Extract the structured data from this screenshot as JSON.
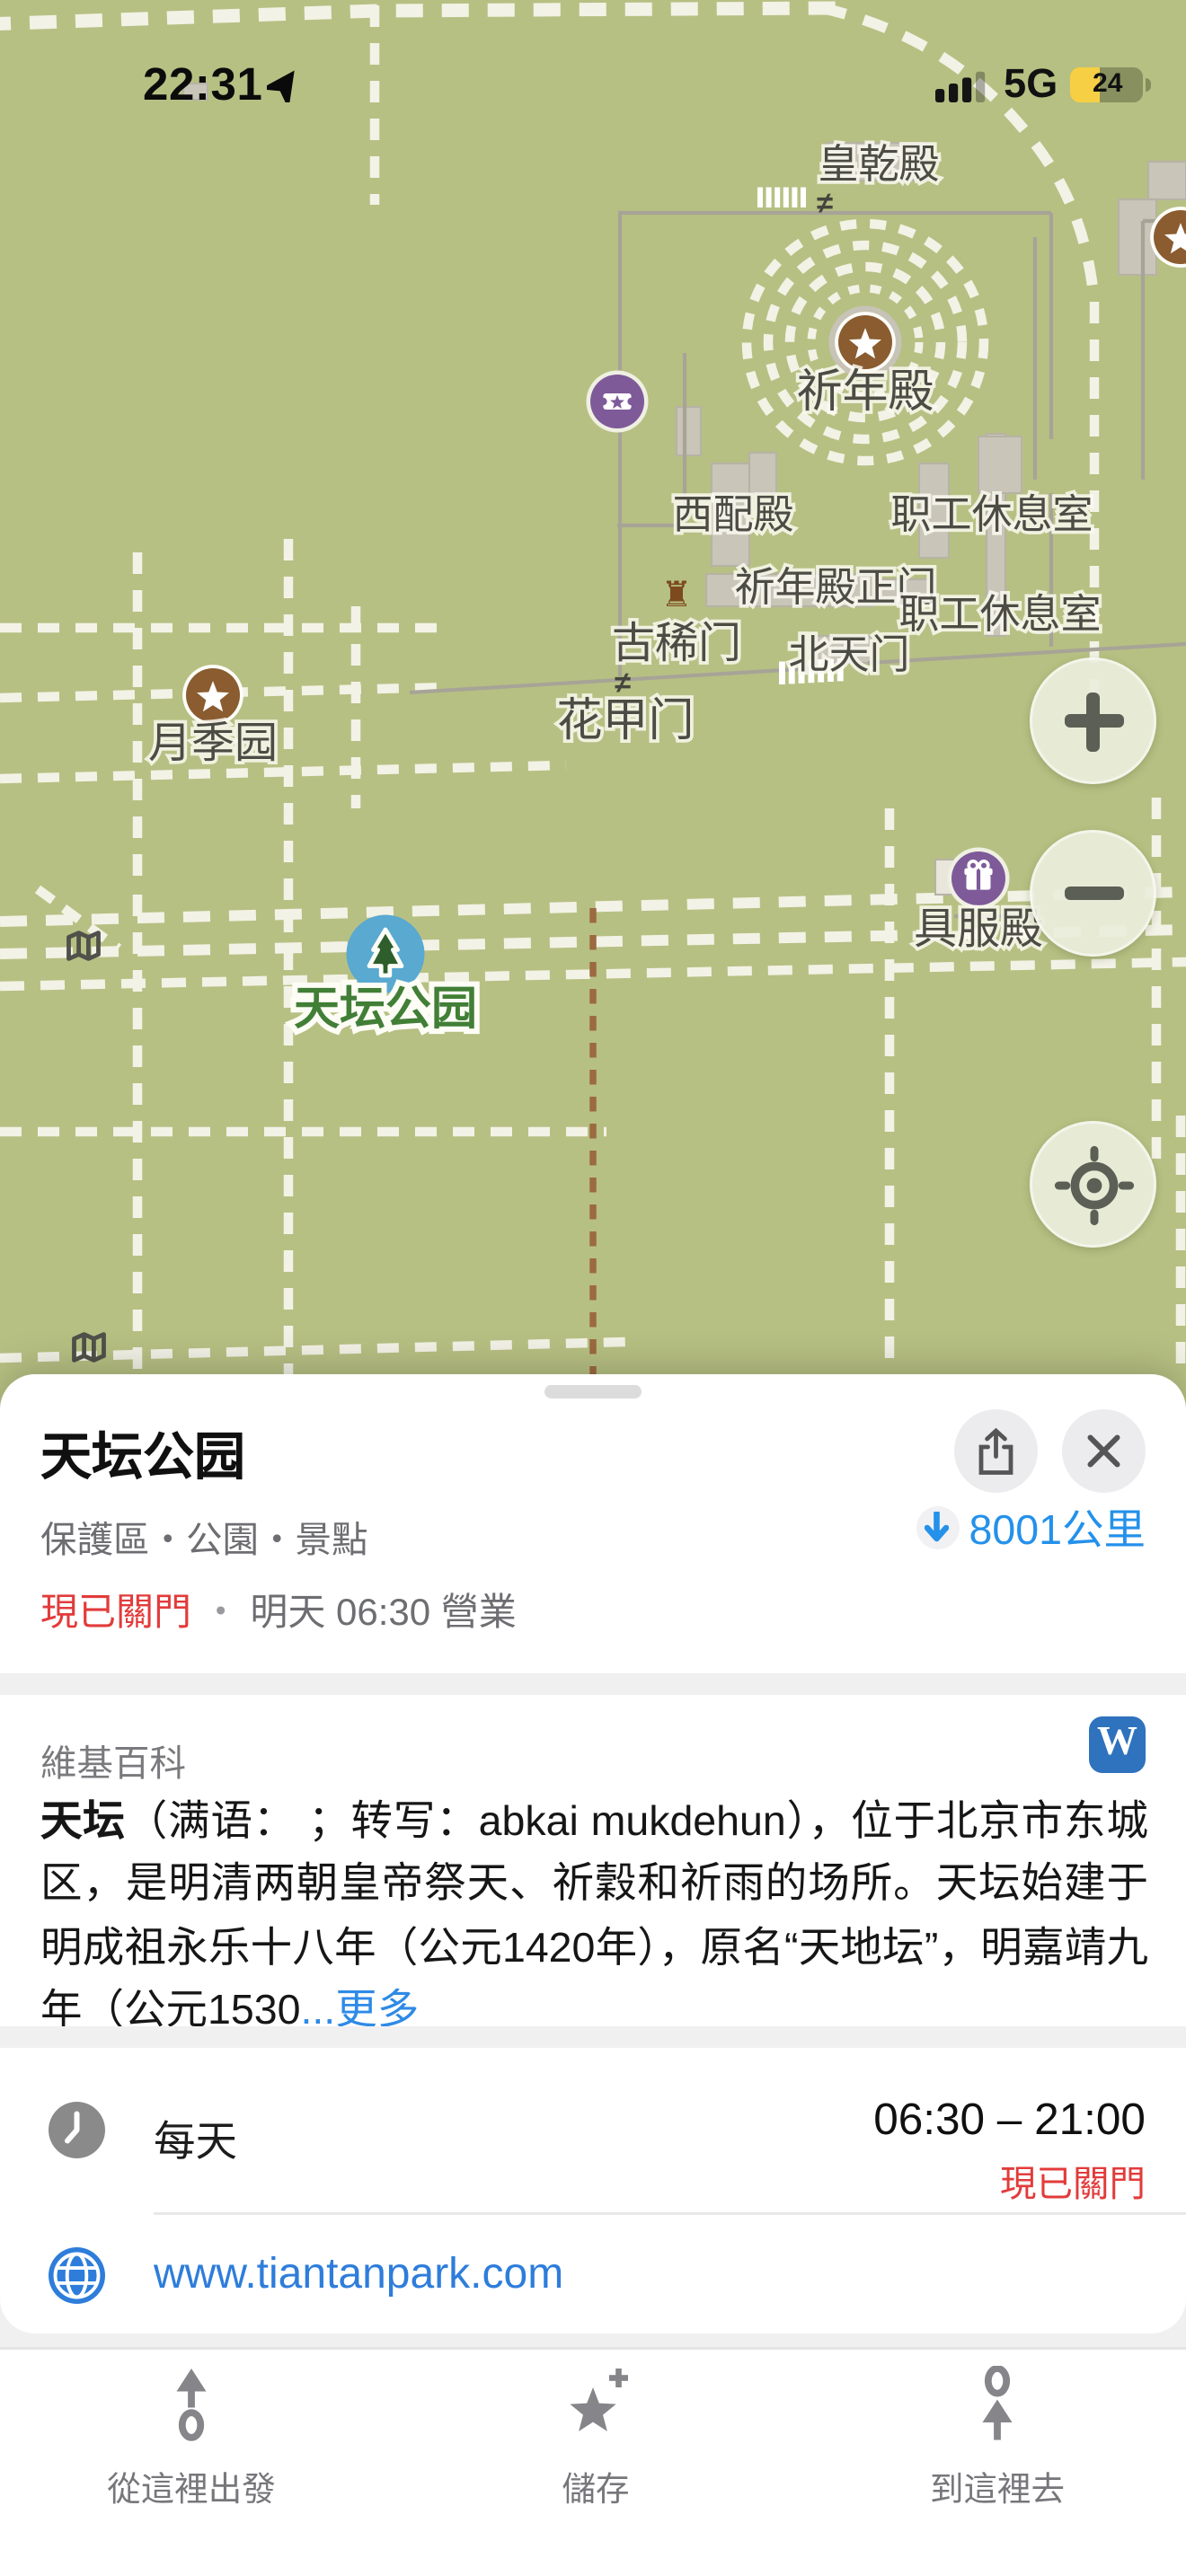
{
  "status_bar": {
    "time": "22:31",
    "network": "5G",
    "battery": "24"
  },
  "map": {
    "place_labels": [
      "皇乾殿",
      "祈年殿",
      "西配殿",
      "职工休息室",
      "祈年殿正门",
      "职工休息室",
      "古稀门",
      "北天门",
      "花甲门",
      "月季园",
      "具服殿"
    ],
    "park_label": "天坛公园",
    "icons": {
      "tower_glyph": "♜",
      "shrine_glyph": "≠",
      "wikipedia_glyph": "W"
    }
  },
  "sheet": {
    "title": "天坛公园",
    "category_line": "保護區・公園・景點",
    "distance": "8001公里",
    "status_closed": "現已關門",
    "status_sep": "・",
    "status_open_info": "明天 06:30 營業"
  },
  "wiki": {
    "section_label": "維基百科",
    "lead": "天坛",
    "body": "（满语： ；转写：abkai mukdehun），位于北京市东城区，是明清两朝皇帝祭天、祈穀和祈雨的场所。天坛始建于明成祖永乐十八年（公元1420年），原名“天地坛”，明嘉靖九年（公元1530",
    "more_label": "...更多"
  },
  "hours": {
    "day_label": "每天",
    "time_range": "06:30 – 21:00",
    "status": "現已關門"
  },
  "website": {
    "url": "www.tiantanpark.com"
  },
  "toolbar": {
    "items": [
      {
        "label": "從這裡出發"
      },
      {
        "label": "儲存"
      },
      {
        "label": "到這裡去"
      }
    ]
  },
  "colors": {
    "map_background": "#b7c083",
    "poi_brown": "#8a5c30",
    "poi_purple": "#7e5a99",
    "park_marker_blue": "#59a9d0",
    "park_label_green": "#417f36",
    "link_blue": "#2e7ddb",
    "distance_blue": "#2491ea",
    "closed_red": "#e23b3b",
    "wikipedia_blue": "#2f72bd",
    "battery_yellow": "#f7cf45"
  }
}
